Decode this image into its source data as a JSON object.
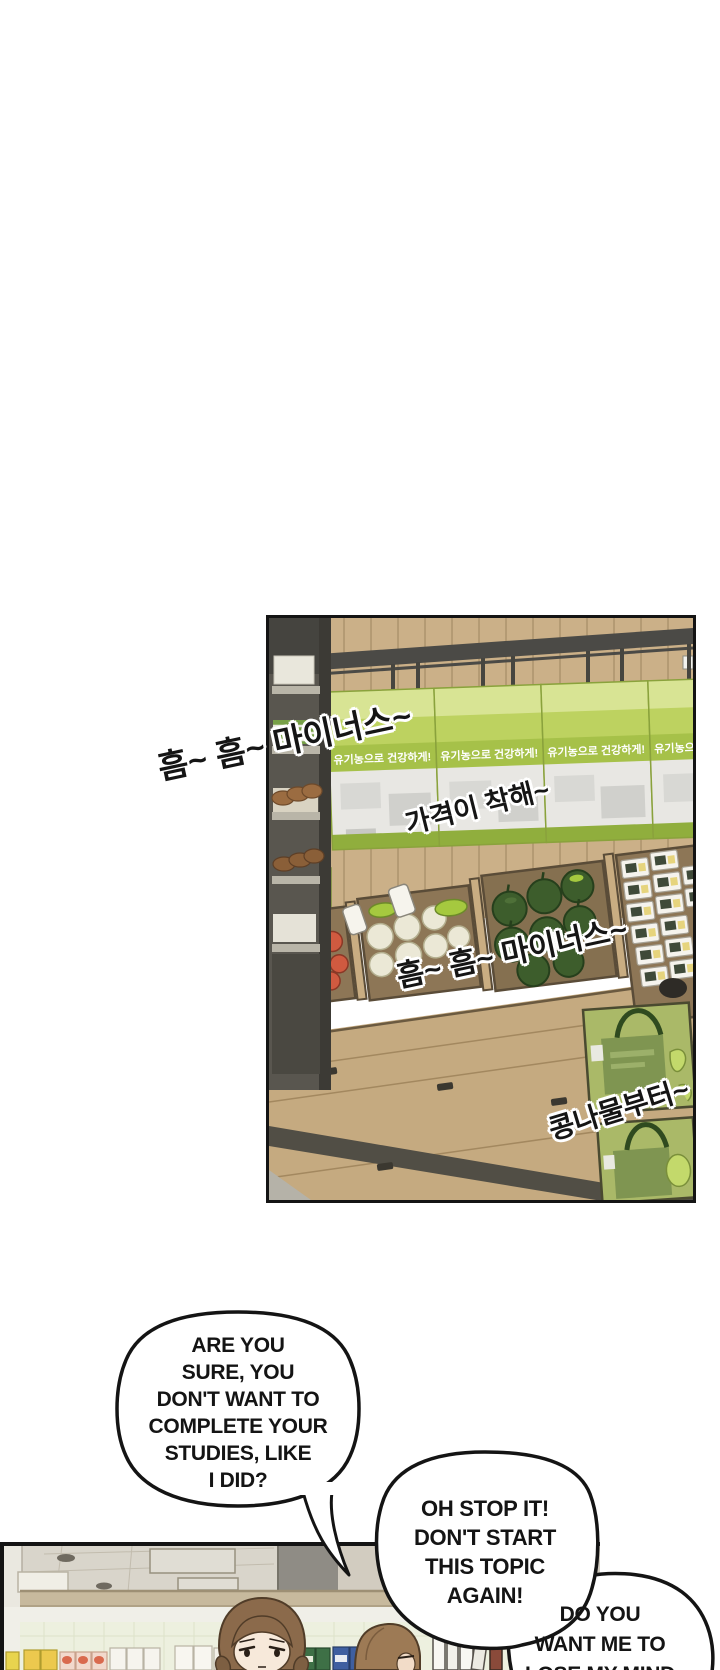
{
  "store_panel": {
    "banner_text": "유기농으로 건강하게!",
    "sfx_humming_1": "흠~ 흠~ 마이너스~",
    "sfx_price": "가격이 착해~",
    "sfx_humming_2": "흠~ 흠~ 마이너스~",
    "sfx_sprouts": "콩나물부터~"
  },
  "dialogue": {
    "bubble1_lines": [
      "ARE YOU",
      "SURE, YOU",
      "DON'T WANT TO",
      "COMPLETE YOUR",
      "STUDIES, LIKE",
      "I DID?"
    ],
    "bubble2_lines": [
      "OH STOP IT!",
      "DON'T START",
      "THIS TOPIC",
      "AGAIN!"
    ],
    "bubble3_lines": [
      "DO YOU",
      "WANT ME TO",
      "LOSE MY MIND"
    ]
  },
  "colors": {
    "panel_border": "#141414",
    "banner_green": "#a6c149",
    "banner_light_green": "#cddc78",
    "wood": "#cbb088",
    "rail_gray": "#4b4a46",
    "watermelon_green": "#3d5d2c",
    "tomato_red": "#d05a40",
    "giftbox_green": "#aab968"
  }
}
